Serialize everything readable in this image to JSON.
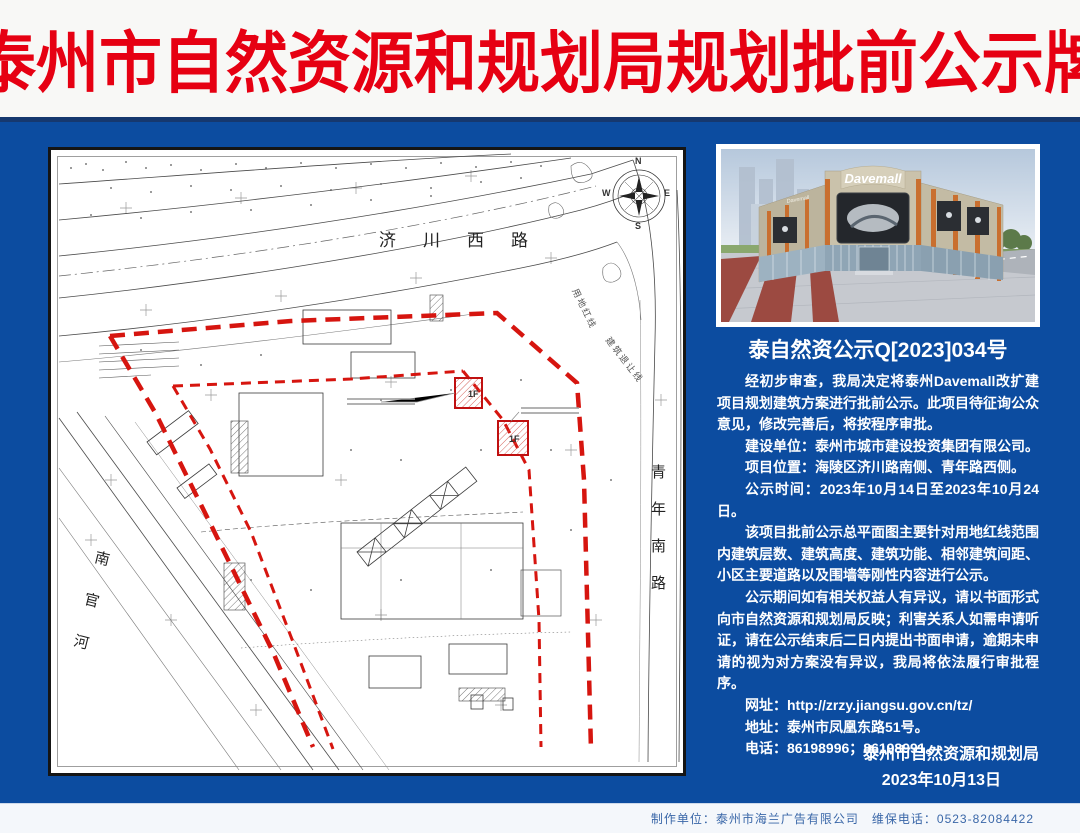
{
  "colors": {
    "background": "#0c4ca0",
    "title_red": "#e60012",
    "boundary_red": "#d6150f",
    "footer_text": "#3a67a8"
  },
  "banner": {
    "title": "泰州市自然资源和规划局规划批前公示牌"
  },
  "map": {
    "labels": {
      "road_top": "济川西路",
      "road_right": "青年南路",
      "river": "南官河",
      "red_line": "用地红线",
      "setback_line": "建筑退让线"
    },
    "compass": {
      "n": "N",
      "e": "E",
      "s": "S",
      "w": "W"
    },
    "floor_tags": [
      "1F",
      "1F"
    ]
  },
  "photo": {
    "logo": "Davemall"
  },
  "notice": {
    "doc_no": "泰自然资公示Q[2023]034号",
    "paragraphs": [
      "经初步审查，我局决定将泰州Davemall改扩建项目规划建筑方案进行批前公示。此项目待征询公众意见，修改完善后，将按程序审批。",
      "建设单位：泰州市城市建设投资集团有限公司。",
      "项目位置：海陵区济川路南侧、青年路西侧。",
      "公示时间：2023年10月14日至2023年10月24日。",
      "该项目批前公示总平面图主要针对用地红线范围内建筑层数、建筑高度、建筑功能、相邻建筑间距、小区主要道路以及围墙等刚性内容进行公示。",
      "公示期间如有相关权益人有异议，请以书面形式向市自然资源和规划局反映；利害关系人如需申请听证，请在公示结束后二日内提出书面申请，逾期未申请的视为对方案没有异议，我局将依法履行审批程序。",
      "网址：http://zrzy.jiangsu.gov.cn/tz/",
      "地址：泰州市凤凰东路51号。",
      "电话：86198996；86198991。"
    ],
    "signature": "泰州市自然资源和规划局",
    "date": "2023年10月13日"
  },
  "footer": {
    "text": "制作单位：泰州市海兰广告有限公司　维保电话：0523-82084422"
  }
}
